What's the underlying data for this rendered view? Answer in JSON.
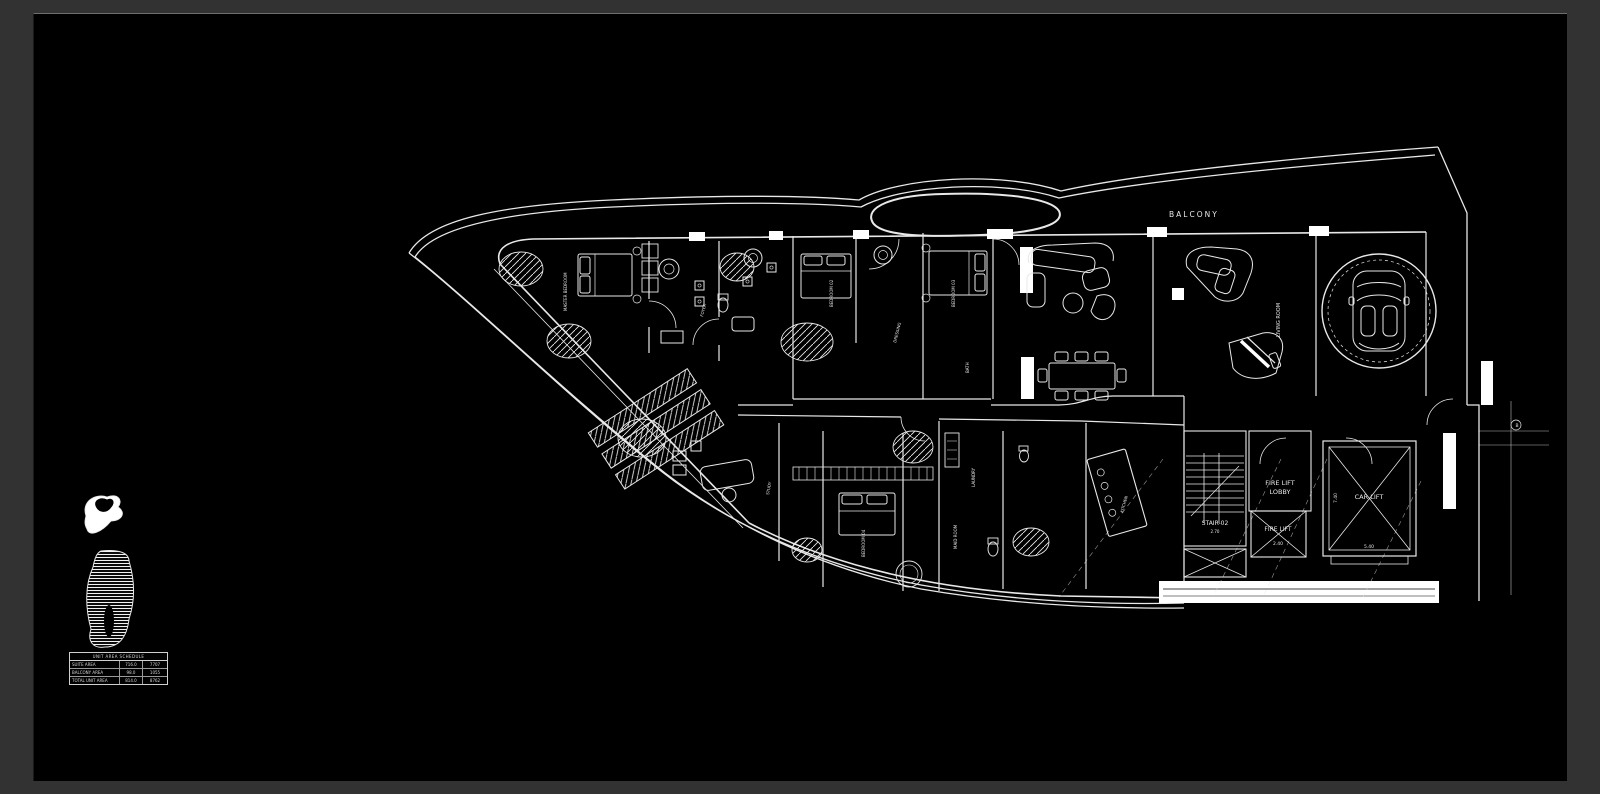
{
  "window": {
    "frame_color": "#323232",
    "canvas_color": "#000000",
    "line_color": "#e8e8e8"
  },
  "plan": {
    "labels": {
      "balcony": "BALCONY",
      "living_room": "LIVING ROOM",
      "fire_lift_lobby_line1": "FIRE LIFT",
      "fire_lift_lobby_line2": "LOBBY",
      "fire_lift": "FIRE LIFT",
      "fire_lift_dim": "2.40",
      "car_lift": "CAR LIFT",
      "car_lift_width": "5.40",
      "car_lift_depth": "7.40",
      "stair": "STAIR-02",
      "stair_dim": "2.70",
      "grid_bubble": "B"
    },
    "room_labels": [
      {
        "text": "MASTER BEDROOM"
      },
      {
        "text": "BEDROOM 02"
      },
      {
        "text": "BEDROOM 03"
      },
      {
        "text": "FOYER"
      },
      {
        "text": "DRESSING"
      },
      {
        "text": "BATH"
      },
      {
        "text": "STUDY"
      },
      {
        "text": "BEDROOM 04"
      },
      {
        "text": "MAID ROOM"
      },
      {
        "text": "LAUNDRY"
      },
      {
        "text": "KITCHEN"
      }
    ]
  },
  "keyplan": {
    "table": {
      "title": "UNIT AREA SCHEDULE",
      "rows": [
        {
          "label": "SUITE AREA",
          "sqm": "716.0",
          "sqft": "7707"
        },
        {
          "label": "BALCONY AREA",
          "sqm": "98.0",
          "sqft": "1055"
        },
        {
          "label": "TOTAL UNIT AREA",
          "sqm": "814.0",
          "sqft": "8762"
        }
      ]
    }
  }
}
